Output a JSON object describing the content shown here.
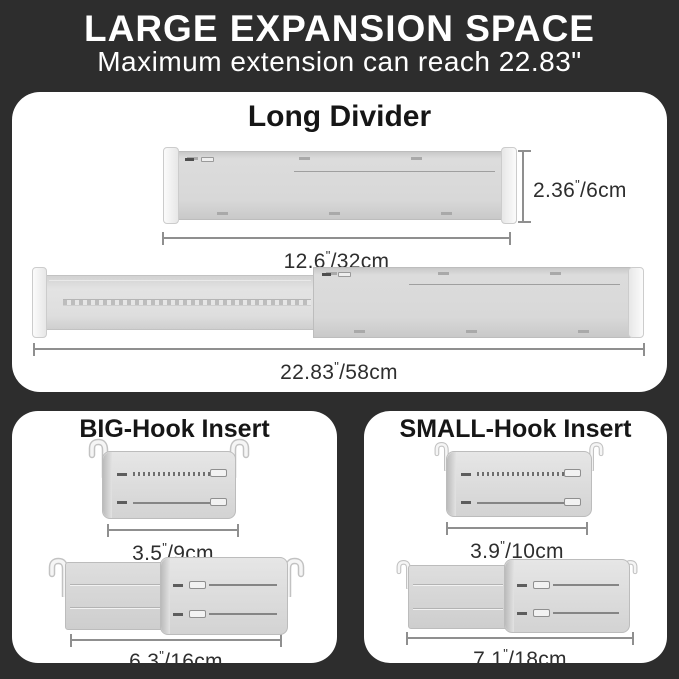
{
  "header": {
    "title": "LARGE EXPANSION SPACE",
    "subtitle": "Maximum extension can reach 22.83\""
  },
  "long_divider": {
    "title": "Long Divider",
    "retracted": {
      "height": {
        "in": "2.36",
        "mark": "\"",
        "cm": "/6cm"
      },
      "width": {
        "in": "12.6",
        "mark": "\"",
        "cm": "/32cm"
      }
    },
    "extended": {
      "width": {
        "in": "22.83",
        "mark": "\"",
        "cm": "/58cm"
      }
    }
  },
  "big_hook": {
    "title": "BIG-Hook Insert",
    "retracted": {
      "width": {
        "in": "3.5",
        "mark": "\"",
        "cm": "/9cm"
      }
    },
    "extended": {
      "width": {
        "in": "6.3",
        "mark": "\"",
        "cm": "/16cm"
      }
    }
  },
  "small_hook": {
    "title": "SMALL-Hook Insert",
    "retracted": {
      "width": {
        "in": "3.9",
        "mark": "\"",
        "cm": "/10cm"
      }
    },
    "extended": {
      "width": {
        "in": "7.1",
        "mark": "\"",
        "cm": "/18cm"
      }
    }
  },
  "colors": {
    "background": "#2d2d2d",
    "card": "#ffffff",
    "header_text": "#ffffff",
    "label_text": "#2e2e2e",
    "product_gray": "#d8d8d8",
    "dimension_line": "#8f8f8f"
  }
}
